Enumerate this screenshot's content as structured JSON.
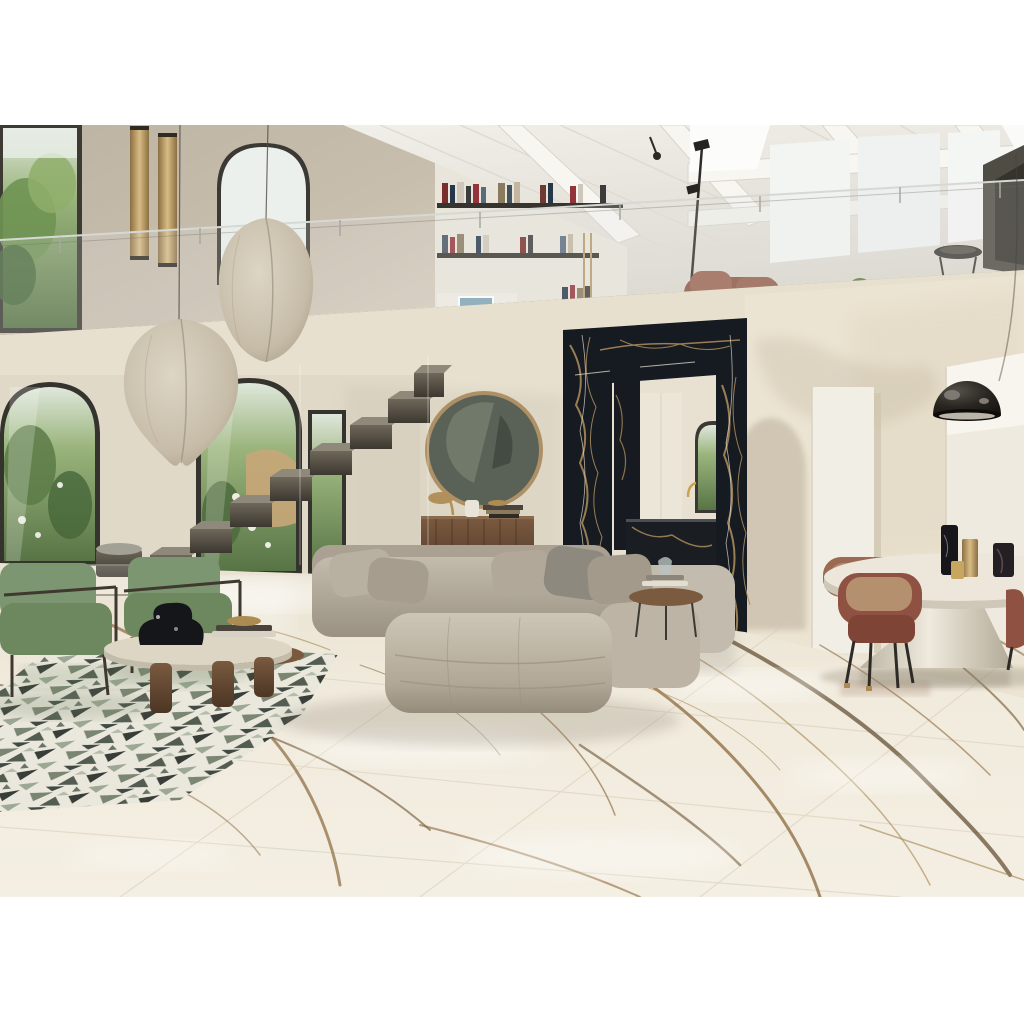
{
  "scene": {
    "type": "interior-photograph",
    "description": "Double-height luxury living room with vaulted white wood ceiling, mezzanine with glass balustrade and bookshelves, cocoon pendant lamps, arched garden windows, floating metal staircase, round brass mirror over walnut sideboard, black-gold marble portal to a kitchen, greige modular sofa with ottomans, green velvet armchairs, terrazzo inlay rug, glossy calacatta gold marble floor, oval dining table with sculptural base, rust leather chairs and a black dome floor lamp",
    "elements": [
      "vaulted-wood-ceiling",
      "mezzanine",
      "glass-balustrade",
      "bookshelves",
      "cocoon-pendant-lamps",
      "arched-windows",
      "floating-staircase",
      "round-mirror",
      "walnut-sideboard",
      "black-marble-portal",
      "kitchen",
      "modular-sofa",
      "ottomans",
      "green-armchairs",
      "coffee-table",
      "terrazzo-rug",
      "marble-floor",
      "dining-table",
      "rust-chairs",
      "dome-floor-lamp",
      "brass-wall-sconces"
    ]
  },
  "colors": {
    "border": "#ffffff",
    "wall_cream": "#e7e0cf",
    "wall_taupe": "#c4baa9",
    "wall_shadow": "#cfc5b1",
    "ceiling": "#edebe3",
    "beam": "#8d8371",
    "glass": "#e4e8e4",
    "sky": "#eef1ee",
    "frame_dark": "#34322c",
    "foliage": "#6f9353",
    "foliage_dark": "#46663a",
    "lamp_shade": "#cfc5b2",
    "brass": "#b28e58",
    "shelf_dark": "#37342f",
    "stairs": "#5c564b",
    "portal": "#161a21",
    "portal_vein": "#a8895a",
    "marble_base": "#f0eadc",
    "marble_vein": "#8a683c",
    "marble_vein_dark": "#5d4729",
    "sofa": "#b2a99a",
    "sofa_light": "#c6beb0",
    "sofa_dark": "#968d7e",
    "green_chair": "#7c9671",
    "green_chair_dark": "#5c7554",
    "wood": "#6b4c34",
    "rust": "#91543f",
    "rust_dark": "#703c2c",
    "table_cream": "#e9e3d4",
    "dome": "#1f1c17",
    "terrazzo_bg": "#e8e5d8",
    "terrazzo_dark": "#20261f",
    "terrazzo_green": "#6d7c63",
    "kitchen_island": "#1a1d22"
  }
}
